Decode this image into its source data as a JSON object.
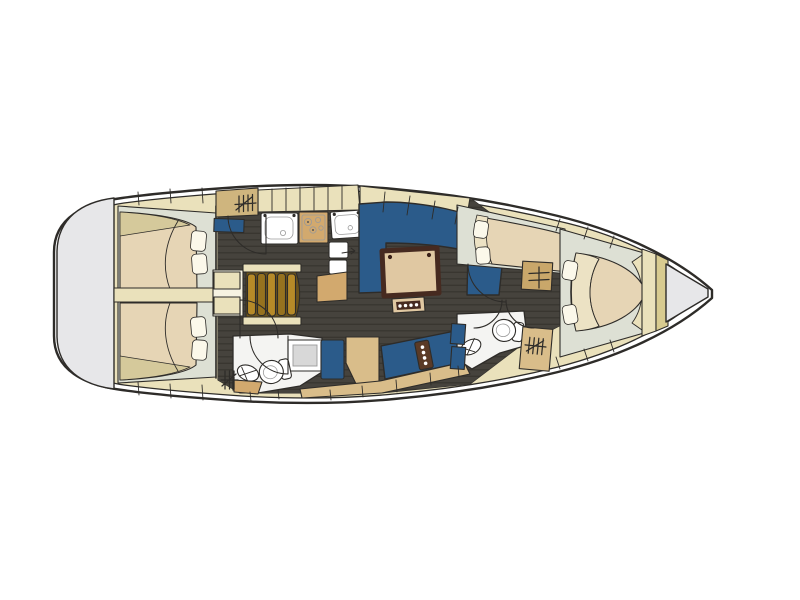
{
  "page_bg": "#ffffff",
  "colors": {
    "page_bg": "#ffffff",
    "outline": "#2e2c29",
    "deck_white": "#ffffff",
    "wood_beige": "#eae1bb",
    "wood_tan": "#d9bd8a",
    "counter_tan": "#d2a96e",
    "locker_tan": "#cfb57e",
    "khaki_band": "#d8cb90",
    "cabin_pale": "#dde0d4",
    "floor_dark": "#46433d",
    "plank_line": "#38352f",
    "upholstery_blue": "#2b5b8a",
    "mattress_tan": "#e6d5b5",
    "sheet_cream": "#ece2c4",
    "blanket_olive": "#d5c99b",
    "pillow_white": "#fbf8ea",
    "fixture_white": "#f4f4f2",
    "shower_gray": "#d8d8d8",
    "platform_gray": "#e7e7e9",
    "steps_dark": "#6b531c",
    "steps_light": "#b68a28",
    "steps_mid": "#96721f",
    "table_wood": "#e0c8a2",
    "table_trim": "#462a20",
    "panel_wood": "#5a3a26",
    "hatch_backing": "#f7f3e2"
  },
  "vessel": {
    "view": "top-down-interior-floor-plan",
    "bow": "right",
    "areas": [
      {
        "id": "swim-platform",
        "position": "stern"
      },
      {
        "id": "aft-cabin-port",
        "fixtures": [
          "double-berth",
          "pillow",
          "pillow"
        ]
      },
      {
        "id": "aft-cabin-starboard",
        "fixtures": [
          "double-berth",
          "pillow",
          "pillow"
        ]
      },
      {
        "id": "companionway",
        "fixtures": [
          "steps",
          "engine-box"
        ]
      },
      {
        "id": "galley",
        "fixtures": [
          "hanging-locker",
          "sink",
          "stove",
          "sink",
          "fridge",
          "counter-peninsula"
        ]
      },
      {
        "id": "salon",
        "fixtures": [
          "u-shaped-settee",
          "dining-table",
          "stool"
        ]
      },
      {
        "id": "aft-head",
        "fixtures": [
          "washbasin",
          "toilet",
          "shower"
        ]
      },
      {
        "id": "nav-station",
        "fixtures": [
          "seat",
          "chart-table",
          "bench-settee",
          "instrument-panel"
        ]
      },
      {
        "id": "mid-cabin",
        "fixtures": [
          "double-berth",
          "pillow",
          "pillow",
          "shelf-cabinet"
        ]
      },
      {
        "id": "forward-head",
        "fixtures": [
          "washbasin",
          "toilet",
          "hanging-locker"
        ]
      },
      {
        "id": "forward-cabin",
        "fixtures": [
          "v-berth",
          "pillow",
          "pillow",
          "shelf"
        ]
      },
      {
        "id": "bow",
        "fixtures": [
          "anchor-locker"
        ]
      }
    ]
  }
}
